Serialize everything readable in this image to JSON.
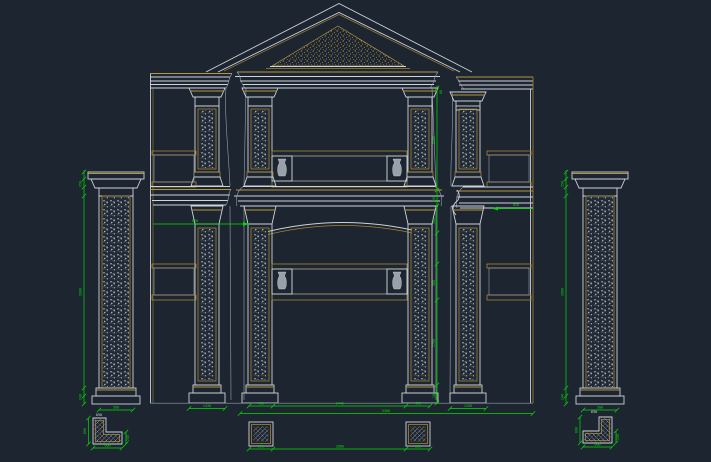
{
  "canvas": {
    "width": 711,
    "height": 462,
    "background": "#1d2531"
  },
  "colors": {
    "line": "#cdd3da",
    "line_dim": "#98a0aa",
    "gold": "#b5953a",
    "gold_dark": "#a8862f",
    "dimension": "#00dc00",
    "text": "#d5dae0"
  },
  "drawing": {
    "type": "architectural-facade-elevation",
    "views": [
      "front-elevation",
      "left-column-elevation",
      "right-column-elevation",
      "column-plan-sections",
      "corner-plan-sections"
    ]
  },
  "dimensions": {
    "v_top_tick": "80",
    "v_upper_floor": "3280",
    "v_belt": "200",
    "v_arch_zone": "580",
    "v_rail": "360",
    "v_column": "1700",
    "v_base": "180",
    "left_wall_arrow": "820",
    "right_wall_arrow": "820",
    "lcol_cap": "350",
    "lcol_shaft": "2800",
    "lcol_base": "240",
    "lcol_width": "500",
    "rcol_cap": "350",
    "rcol_shaft": "2800",
    "rcol_base": "240",
    "rcol_width": "500",
    "bay_left": "450",
    "bay_span": "2440",
    "bay_right": "450",
    "overall_width": "5360",
    "sq_left": "500",
    "bay_bottom": "2880",
    "sq_right": "500",
    "left_wall_base": "1430",
    "right_wall_base": "1430",
    "ldet_height": "600",
    "ldet_leg": "240",
    "ldet_width": "600",
    "ldet_label": "650",
    "rdet_height": "600",
    "rdet_leg": "240",
    "rdet_width": "600",
    "rdet_label": "650"
  }
}
